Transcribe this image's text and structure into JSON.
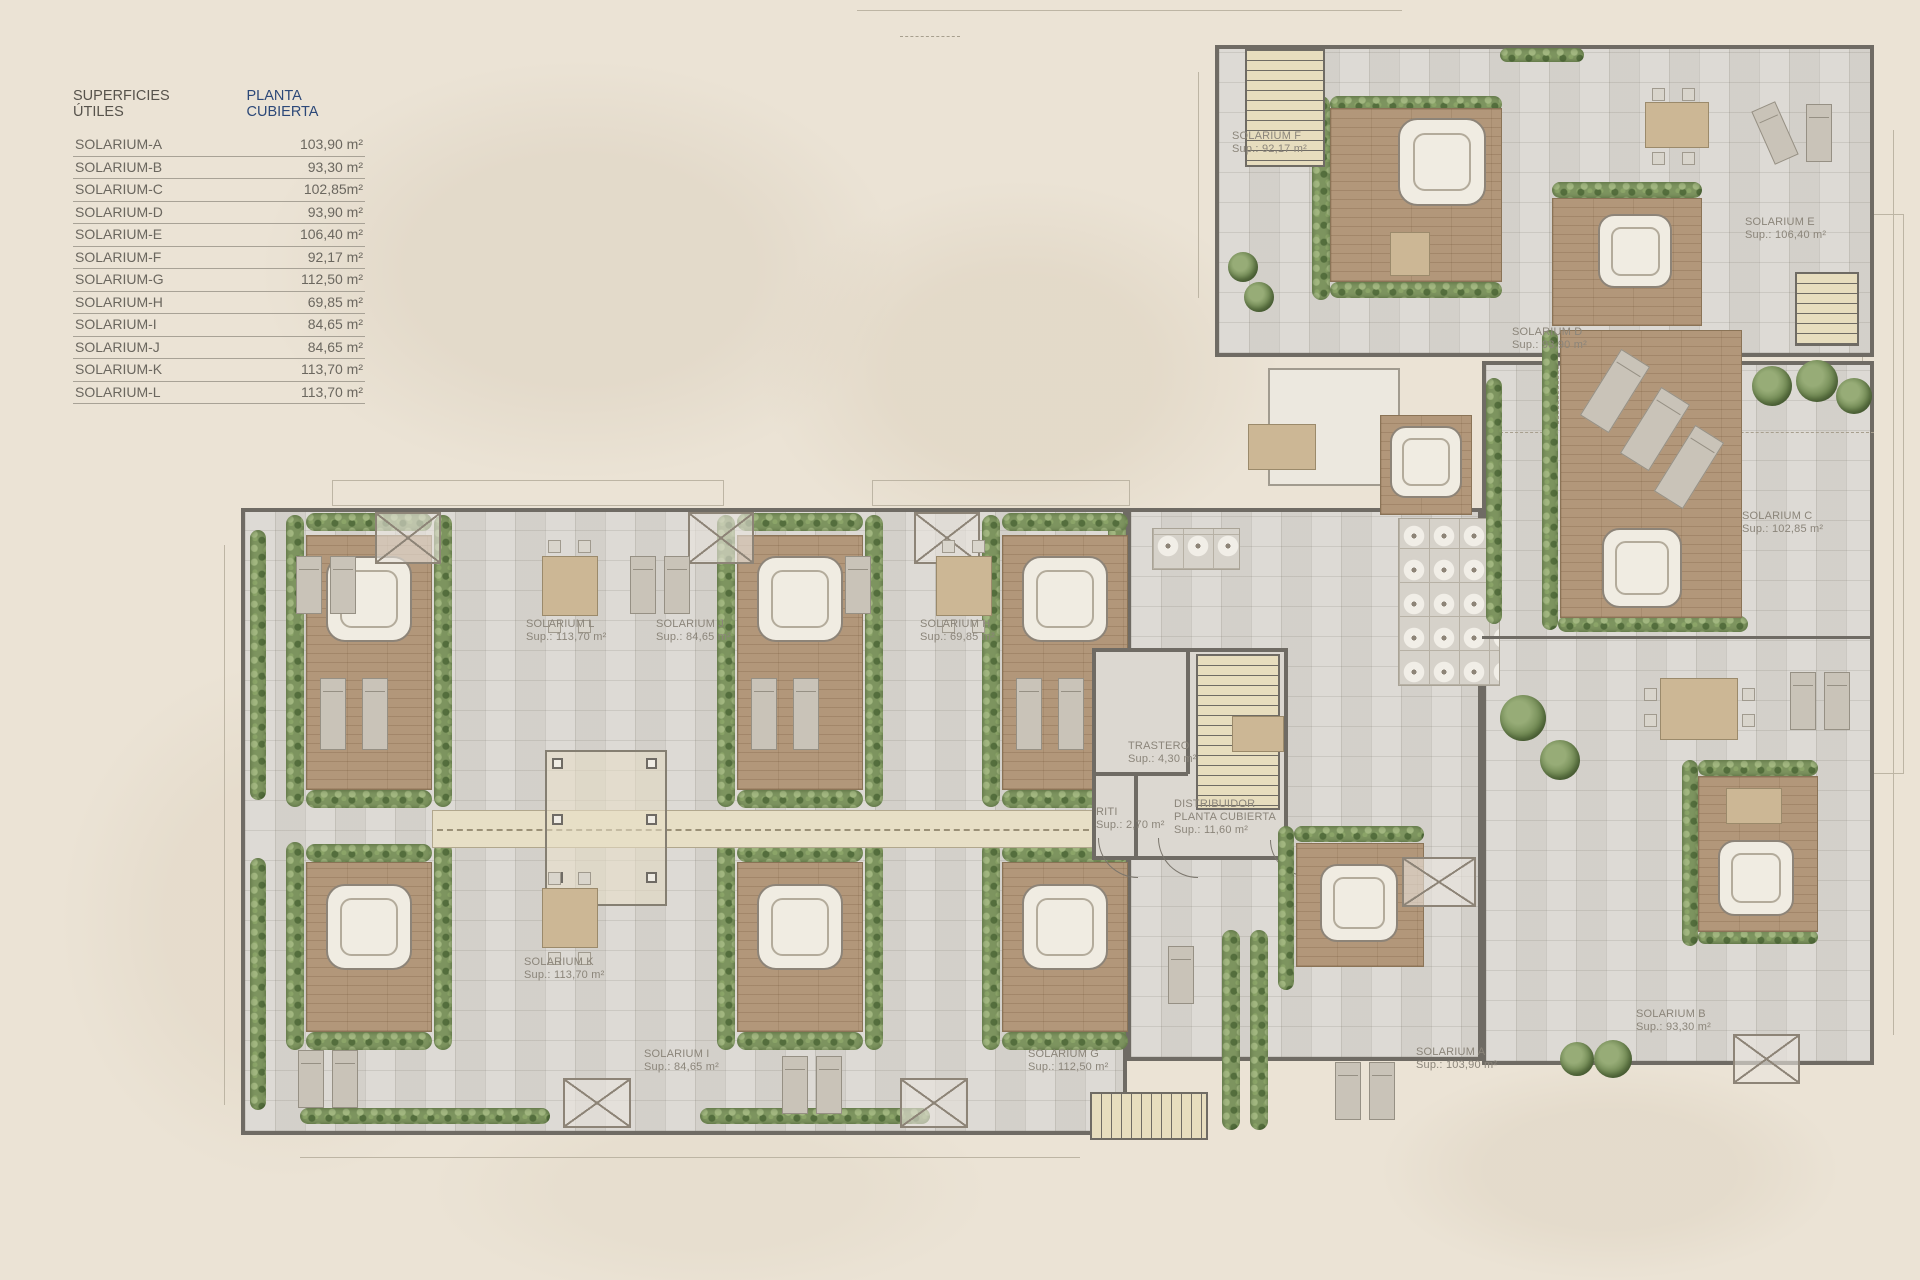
{
  "legend": {
    "title": "SUPERFICIES ÚTILES",
    "subtitle": "PLANTA CUBIERTA",
    "rows": [
      {
        "name": "SOLARIUM-A",
        "area": "103,90 m²"
      },
      {
        "name": "SOLARIUM-B",
        "area": "93,30 m²"
      },
      {
        "name": "SOLARIUM-C",
        "area": "102,85m²"
      },
      {
        "name": "SOLARIUM-D",
        "area": "93,90 m²"
      },
      {
        "name": "SOLARIUM-E",
        "area": "106,40 m²"
      },
      {
        "name": "SOLARIUM-F",
        "area": "92,17 m²"
      },
      {
        "name": "SOLARIUM-G",
        "area": "112,50 m²"
      },
      {
        "name": "SOLARIUM-H",
        "area": "69,85 m²"
      },
      {
        "name": "SOLARIUM-I",
        "area": "84,65 m²"
      },
      {
        "name": "SOLARIUM-J",
        "area": "84,65 m²"
      },
      {
        "name": "SOLARIUM-K",
        "area": "113,70 m²"
      },
      {
        "name": "SOLARIUM-L",
        "area": "113,70 m²"
      }
    ]
  },
  "plan": {
    "labels": [
      {
        "name": "SOLARIUM F",
        "sup": "Sup.: 92,17 m²"
      },
      {
        "name": "SOLARIUM E",
        "sup": "Sup.: 106,40 m²"
      },
      {
        "name": "SOLARIUM D",
        "sup": "Sup.: 93,90 m²"
      },
      {
        "name": "SOLARIUM C",
        "sup": "Sup.: 102,85 m²"
      },
      {
        "name": "SOLARIUM B",
        "sup": "Sup.: 93,30 m²"
      },
      {
        "name": "SOLARIUM A",
        "sup": "Sup.: 103,90 m²"
      },
      {
        "name": "SOLARIUM L",
        "sup": "Sup.: 113,70 m²"
      },
      {
        "name": "SOLARIUM J",
        "sup": "Sup.: 84,65 m²"
      },
      {
        "name": "SOLARIUM H",
        "sup": "Sup.: 69,85 m²"
      },
      {
        "name": "SOLARIUM K",
        "sup": "Sup.: 113,70 m²"
      },
      {
        "name": "SOLARIUM I",
        "sup": "Sup.: 84,65 m²"
      },
      {
        "name": "SOLARIUM G",
        "sup": "Sup.: 112,50 m²"
      },
      {
        "name": "TRASTERO",
        "sup": "Sup.: 4,30 m²"
      },
      {
        "name": "RITI",
        "sup": "Sup.: 2,70 m²"
      },
      {
        "name": "DISTRIBUIDOR",
        "name2": "PLANTA CUBIERTA",
        "sup": "Sup.: 11,60 m²"
      }
    ]
  },
  "colors": {
    "background": "#ebe3d5",
    "tile": "#d9d6d0",
    "wall": "#6f6b64",
    "wood_deck": "#b2977a",
    "hedge_green": "#7d945f",
    "legend_accent": "#2c4878",
    "plan_label_text": "#8b857a"
  }
}
